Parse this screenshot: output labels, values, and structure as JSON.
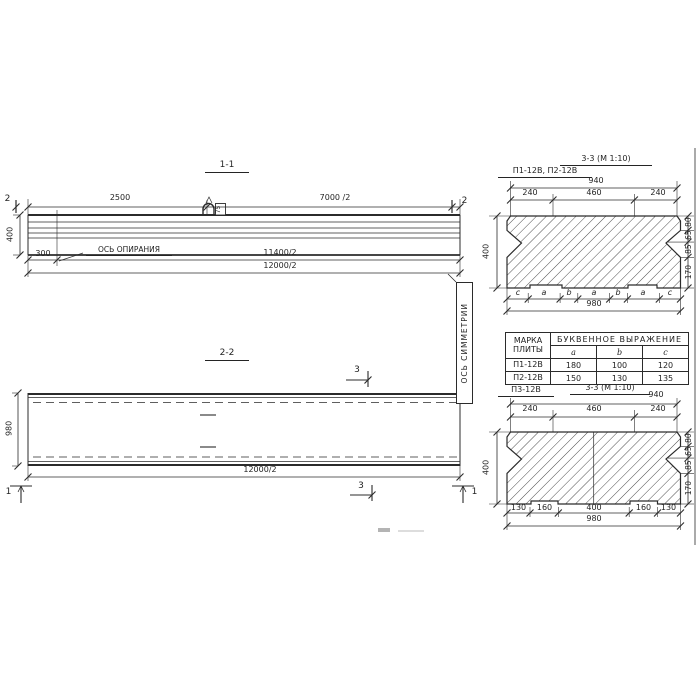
{
  "ink_color": "#2b2b2b",
  "paper_color": "#ffffff",
  "section_1_1": {
    "title": "1-1",
    "dim_2500": "2500",
    "dim_7000_half": "7000 /2",
    "section_mark_2": "2",
    "height_400": "400",
    "dim_300": "300",
    "bearing_axis_label": "ОСЬ ОПИРАНИЯ",
    "dim_11400_half": "11400/2",
    "dim_12000_half": "12000/2",
    "loop_label": "75"
  },
  "section_2_2": {
    "title": "2-2",
    "section_mark_3": "3",
    "section_mark_1": "1",
    "width_980": "980",
    "dim_12000_half": "12000/2"
  },
  "symmetry_axis_label": "ОСЬ СИММЕТРИИ",
  "section_3_3_top": {
    "title": "3-3 (М 1:10)",
    "plate_marks": "П1-12В, П2-12В",
    "dim_940": "940",
    "dim_240_left": "240",
    "dim_460": "460",
    "dim_240_right": "240",
    "height_400": "400",
    "right_dims": [
      "80",
      "65",
      "85",
      "170"
    ],
    "letter_dims": [
      "c",
      "a",
      "b",
      "a",
      "b",
      "a",
      "c"
    ],
    "dim_980": "980"
  },
  "dimension_table": {
    "header_mark": "МАРКА ПЛИТЫ",
    "header_expression": "БУКВЕННОЕ ВЫРАЖЕНИЕ",
    "columns": [
      "a",
      "b",
      "c"
    ],
    "rows": [
      {
        "mark": "П1-12В",
        "a": "180",
        "b": "100",
        "c": "120"
      },
      {
        "mark": "П2-12В",
        "a": "150",
        "b": "130",
        "c": "135"
      }
    ]
  },
  "section_3_3_bottom": {
    "plate_mark": "П3-12В",
    "title": "3-3 (М 1:10)",
    "dim_940": "940",
    "dim_240_left": "240",
    "dim_460": "460",
    "dim_240_right": "240",
    "height_400": "400",
    "right_dims": [
      "80",
      "65",
      "85",
      "170"
    ],
    "bottom_dims": [
      "130",
      "160",
      "400",
      "160",
      "130"
    ],
    "dim_980": "980"
  }
}
